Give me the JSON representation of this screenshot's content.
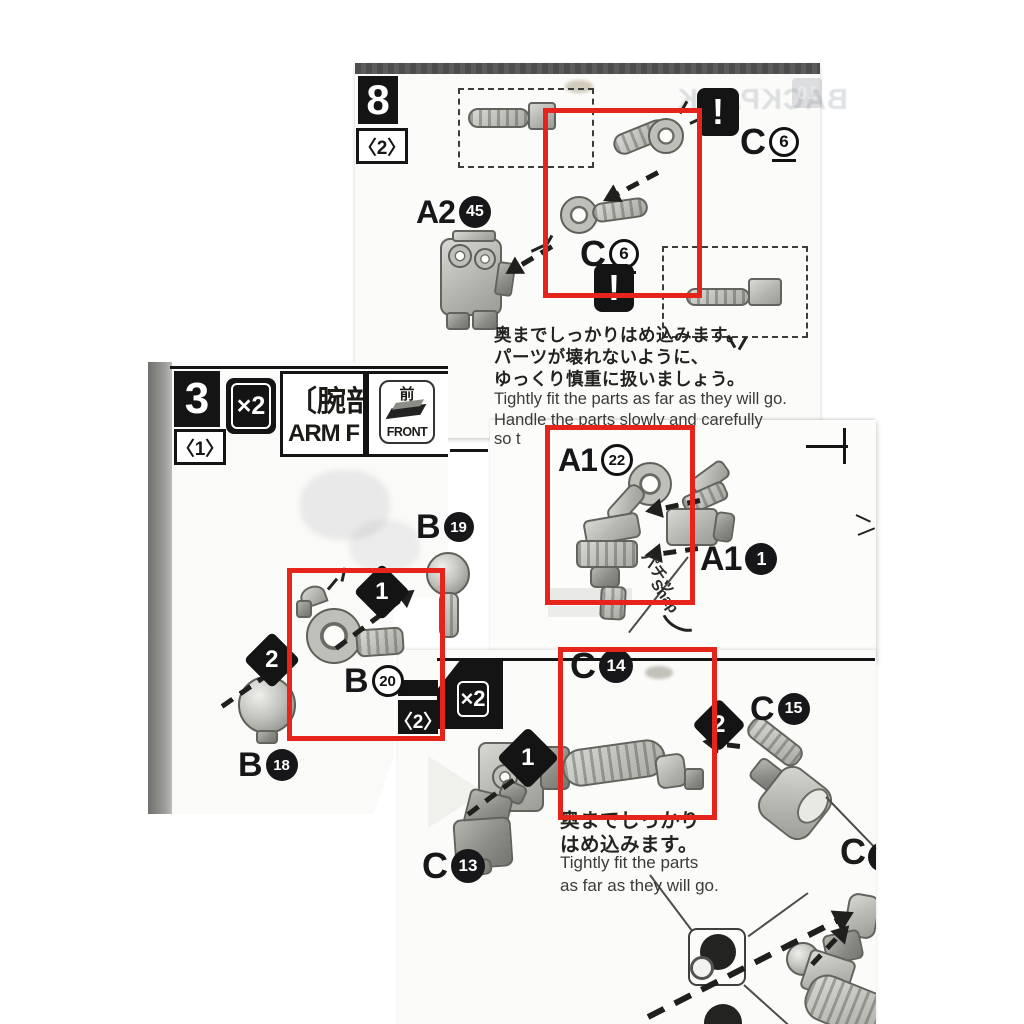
{
  "annotations": {
    "highlight_color": "#e5241c",
    "highlight_count": 4
  },
  "page8": {
    "step": "8",
    "unit": "〈2〉",
    "warning": "!",
    "warning2": "!",
    "label_c6_top": {
      "prefix": "C",
      "num": "6"
    },
    "label_c6_mid": {
      "prefix": "C",
      "num": "6"
    },
    "label_a2": {
      "prefix": "A2",
      "num": "45"
    },
    "jp1": "奥までしっかりはめ込みます。",
    "jp2": "パーツが壊れないように、",
    "jp3": "ゆっくり慎重に扱いましょう。",
    "en1": "Tightly fit the parts as far as they will go.",
    "en2": "Handle the parts slowly and carefully",
    "en3": "so t",
    "ghost_num": "10",
    "ghost_text": "BACKPACK"
  },
  "page3": {
    "step": "3",
    "unit": "〈1〉",
    "multiplier": "×2",
    "title_jp": "〔腕部",
    "title_en": "ARM F",
    "front_kanji": "前",
    "front_label": "FRONT",
    "marker1": "1",
    "marker2": "2",
    "label_b19": {
      "prefix": "B",
      "num": "19"
    },
    "label_b20": {
      "prefix": "B",
      "num": "20"
    },
    "label_b18": {
      "prefix": "B",
      "num": "18"
    }
  },
  "pageA1": {
    "label_a1_22": {
      "prefix": "A1",
      "num": "22"
    },
    "label_a1_1": {
      "prefix": "A1",
      "num": "1"
    },
    "snap_jp": "パチッ",
    "snap_en": "Snap"
  },
  "pageBottom": {
    "multiplier": "×2",
    "unit": "〈2〉",
    "marker1": "1",
    "marker2": "2",
    "label_c14": {
      "prefix": "C",
      "num": "14"
    },
    "label_c15": {
      "prefix": "C",
      "num": "15"
    },
    "label_c13": {
      "prefix": "C",
      "num": "13"
    },
    "label_c_cut": "C",
    "jp1": "奥までしっかり",
    "jp2": "はめ込みます。",
    "en1": "Tightly fit the parts",
    "en2": "as far as they will go."
  }
}
